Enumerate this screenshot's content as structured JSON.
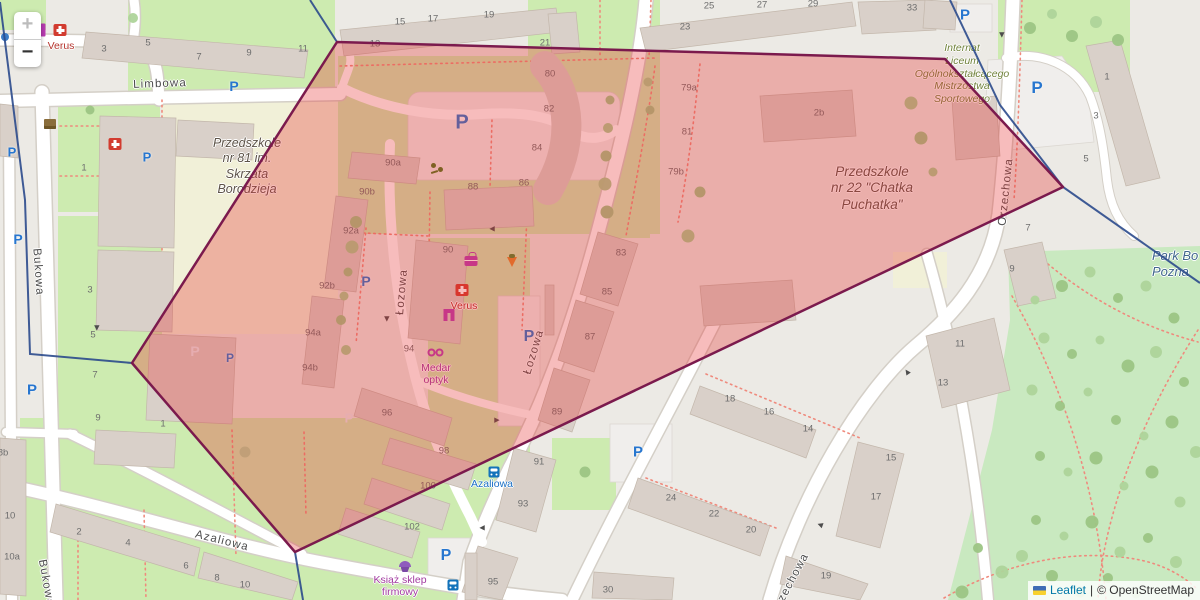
{
  "controls": {
    "zoom_in": "+",
    "zoom_out": "−"
  },
  "attribution": {
    "flag_icon": "ukraine-flag",
    "leaflet_link": "Leaflet",
    "separator": "|",
    "osm_credit": "© OpenStreetMap"
  },
  "colors": {
    "overlay_fill": "#e63030",
    "overlay_stroke": "#7b1a4d",
    "boundary_blue": "#2b4a8c",
    "parking_blue": "#2776cf",
    "bus_blue": "#1473ba",
    "pharmacy_red": "#d23b2f",
    "shop_magenta": "#b93cb1",
    "street_text": "#4c4c4c",
    "housenumber_text": "#6e6e6e",
    "kindergarten_text": "#5d5348",
    "dormitory_text": "#70823b",
    "park_text": "#40678c",
    "bus_label": "#1a6fc4",
    "pharmacy_label": "#b5342d",
    "shop_label": "#a23aa0"
  },
  "overlay": {
    "polygon_points": "337,42 945,59 1063,187 295,552 132,363",
    "fill_opacity": "0.32",
    "blue_segments": [
      "310,0 337,42",
      "0,2 25,200 30,354 132,363",
      "295,552 303,600",
      "950,0 1000,105 1063,187 1200,283"
    ]
  },
  "street_labels": [
    {
      "text": "Limbowa",
      "x": 160,
      "y": 84,
      "rot": -2
    },
    {
      "text": "Bukowa",
      "x": 38,
      "y": 272,
      "rot": 86
    },
    {
      "text": "Bukowa",
      "x": 46,
      "y": 583,
      "rot": 80
    },
    {
      "text": "Łozowa",
      "x": 402,
      "y": 292,
      "rot": -85
    },
    {
      "text": "Łozowa",
      "x": 534,
      "y": 352,
      "rot": -73
    },
    {
      "text": "Azaliowa",
      "x": 222,
      "y": 541,
      "rot": 14
    },
    {
      "text": "Orzechowa",
      "x": 1006,
      "y": 192,
      "rot": -84
    },
    {
      "text": "Orzechowa",
      "x": 790,
      "y": 584,
      "rot": -62
    }
  ],
  "area_labels": [
    {
      "name": "przedszkole-81",
      "lines": [
        "Przedszkole",
        "nr 81 im.",
        "Skrzata",
        "Borodzieja"
      ],
      "x": 247,
      "y": 136,
      "size": 12.5,
      "color_key": "kindergarten_text"
    },
    {
      "name": "przedszkole-22",
      "lines": [
        "Przedszkole",
        "nr 22 \"Chatka",
        "Puchatka\""
      ],
      "x": 872,
      "y": 164,
      "size": 13.5,
      "color_key": "kindergarten_text"
    },
    {
      "name": "internat-liceum",
      "lines": [
        "Internat",
        "Liceum",
        "Ogólnokształcącego",
        "Mistrzostwa",
        "Sportowego"
      ],
      "x": 962,
      "y": 42,
      "size": 10.5,
      "color_key": "dormitory_text"
    },
    {
      "name": "park",
      "lines": [
        "Park Bo",
        "Pozna"
      ],
      "x": 1152,
      "y": 248,
      "size": 13,
      "color_key": "park_text",
      "left_align": true
    }
  ],
  "poi_labels": [
    {
      "name": "verus-pharmacy-1",
      "lines": [
        "Verus"
      ],
      "x": 61,
      "y": 40,
      "color_key": "pharmacy_label"
    },
    {
      "name": "verus-pharmacy-2",
      "lines": [
        "Verus"
      ],
      "x": 464,
      "y": 300,
      "color_key": "pharmacy_label"
    },
    {
      "name": "medar-optyk",
      "lines": [
        "Medar",
        "optyk"
      ],
      "x": 436,
      "y": 362,
      "color_key": "shop_label"
    },
    {
      "name": "ksiaz-sklep",
      "lines": [
        "Książ sklep",
        "firmowy"
      ],
      "x": 400,
      "y": 574,
      "color_key": "shop_label"
    },
    {
      "name": "azaliowa-bus-stop",
      "lines": [
        "Azaliowa"
      ],
      "x": 492,
      "y": 478,
      "color_key": "bus_label"
    }
  ],
  "poi_icons": [
    {
      "kind": "pharmacy",
      "x": 60,
      "y": 30
    },
    {
      "kind": "pharmacy",
      "x": 115,
      "y": 144
    },
    {
      "kind": "pharmacy",
      "x": 462,
      "y": 290
    },
    {
      "kind": "parcel-locker",
      "x": 50,
      "y": 124
    },
    {
      "kind": "playground",
      "x": 437,
      "y": 168
    },
    {
      "kind": "gift-shop",
      "x": 471,
      "y": 261
    },
    {
      "kind": "greengrocer",
      "x": 512,
      "y": 262
    },
    {
      "kind": "clothes-shop",
      "x": 449,
      "y": 317
    },
    {
      "kind": "optician",
      "x": 435,
      "y": 352
    },
    {
      "kind": "confectionery",
      "x": 405,
      "y": 564
    },
    {
      "kind": "poi-dot",
      "x": 5,
      "y": 37
    },
    {
      "kind": "shop-bar",
      "x": 43,
      "y": 30
    },
    {
      "kind": "bus-stop",
      "x": 494,
      "y": 472
    },
    {
      "kind": "bus-stop",
      "x": 453,
      "y": 585
    }
  ],
  "parking": [
    [
      12,
      152,
      13,
      "b"
    ],
    [
      147,
      157,
      13,
      "b"
    ],
    [
      234,
      86,
      14,
      "b"
    ],
    [
      18,
      239,
      14,
      "b"
    ],
    [
      32,
      390,
      15,
      "b"
    ],
    [
      195,
      351,
      14,
      "l"
    ],
    [
      230,
      358,
      12,
      "b"
    ],
    [
      366,
      281,
      14,
      "b"
    ],
    [
      349,
      418,
      13,
      "l"
    ],
    [
      462,
      123,
      20,
      "b"
    ],
    [
      529,
      337,
      16,
      "b"
    ],
    [
      446,
      556,
      16,
      "b"
    ],
    [
      638,
      452,
      15,
      "b"
    ],
    [
      965,
      15,
      15,
      "b"
    ],
    [
      1037,
      88,
      17,
      "b"
    ]
  ],
  "housenumbers": [
    [
      104,
      49,
      "3"
    ],
    [
      148,
      43,
      "5"
    ],
    [
      199,
      57,
      "7"
    ],
    [
      249,
      53,
      "9"
    ],
    [
      303,
      49,
      "11"
    ],
    [
      375,
      44,
      "13"
    ],
    [
      400,
      22,
      "15"
    ],
    [
      433,
      19,
      "17"
    ],
    [
      489,
      15,
      "19"
    ],
    [
      545,
      43,
      "21"
    ],
    [
      685,
      27,
      "23"
    ],
    [
      709,
      6,
      "25"
    ],
    [
      762,
      5,
      "27"
    ],
    [
      813,
      4,
      "29"
    ],
    [
      912,
      8,
      "33"
    ],
    [
      84,
      168,
      "1"
    ],
    [
      90,
      290,
      "3"
    ],
    [
      93,
      335,
      "5"
    ],
    [
      95,
      375,
      "7"
    ],
    [
      98,
      418,
      "9"
    ],
    [
      163,
      424,
      "1"
    ],
    [
      3,
      453,
      "8b"
    ],
    [
      10,
      516,
      "10"
    ],
    [
      12,
      557,
      "10a"
    ],
    [
      79,
      532,
      "2"
    ],
    [
      128,
      543,
      "4"
    ],
    [
      186,
      566,
      "6"
    ],
    [
      217,
      578,
      "8"
    ],
    [
      245,
      585,
      "10"
    ],
    [
      550,
      74,
      "80"
    ],
    [
      549,
      109,
      "82"
    ],
    [
      537,
      148,
      "84"
    ],
    [
      524,
      183,
      "86"
    ],
    [
      473,
      187,
      "88"
    ],
    [
      448,
      250,
      "90"
    ],
    [
      393,
      163,
      "90a"
    ],
    [
      367,
      192,
      "90b"
    ],
    [
      351,
      231,
      "92a"
    ],
    [
      327,
      286,
      "92b"
    ],
    [
      313,
      333,
      "94a"
    ],
    [
      310,
      368,
      "94b"
    ],
    [
      409,
      349,
      "94"
    ],
    [
      387,
      413,
      "96"
    ],
    [
      444,
      451,
      "98"
    ],
    [
      428,
      486,
      "100"
    ],
    [
      412,
      527,
      "102"
    ],
    [
      689,
      88,
      "79a"
    ],
    [
      687,
      132,
      "81"
    ],
    [
      676,
      172,
      "79b"
    ],
    [
      819,
      113,
      "2b"
    ],
    [
      621,
      253,
      "83"
    ],
    [
      607,
      292,
      "85"
    ],
    [
      590,
      337,
      "87"
    ],
    [
      557,
      412,
      "89"
    ],
    [
      539,
      462,
      "91"
    ],
    [
      523,
      504,
      "93"
    ],
    [
      493,
      582,
      "95"
    ],
    [
      608,
      590,
      "30"
    ],
    [
      730,
      399,
      "18"
    ],
    [
      769,
      412,
      "16"
    ],
    [
      808,
      429,
      "14"
    ],
    [
      671,
      498,
      "24"
    ],
    [
      714,
      514,
      "22"
    ],
    [
      751,
      530,
      "20"
    ],
    [
      826,
      576,
      "19"
    ],
    [
      876,
      497,
      "17"
    ],
    [
      891,
      458,
      "15"
    ],
    [
      1107,
      77,
      "1"
    ],
    [
      1096,
      116,
      "3"
    ],
    [
      1086,
      159,
      "5"
    ],
    [
      1028,
      228,
      "7"
    ],
    [
      1012,
      269,
      "9"
    ],
    [
      960,
      344,
      "11"
    ],
    [
      943,
      383,
      "13"
    ]
  ],
  "trees_tinted": [
    [
      356,
      222
    ],
    [
      352,
      247
    ],
    [
      348,
      272
    ],
    [
      344,
      296
    ],
    [
      341,
      320
    ],
    [
      346,
      350
    ],
    [
      610,
      100
    ],
    [
      608,
      128
    ],
    [
      606,
      156
    ],
    [
      605,
      184
    ],
    [
      607,
      212
    ],
    [
      648,
      82
    ],
    [
      650,
      110
    ],
    [
      688,
      236
    ],
    [
      700,
      192
    ],
    [
      911,
      103
    ],
    [
      921,
      138
    ],
    [
      933,
      172
    ]
  ],
  "trees_park": [
    [
      1030,
      28
    ],
    [
      1052,
      14
    ],
    [
      1072,
      36
    ],
    [
      1096,
      22
    ],
    [
      1118,
      40
    ],
    [
      1035,
      300
    ],
    [
      1062,
      286
    ],
    [
      1090,
      272
    ],
    [
      1118,
      298
    ],
    [
      1146,
      286
    ],
    [
      1174,
      318
    ],
    [
      1044,
      338
    ],
    [
      1072,
      354
    ],
    [
      1100,
      340
    ],
    [
      1128,
      366
    ],
    [
      1156,
      352
    ],
    [
      1184,
      382
    ],
    [
      1032,
      390
    ],
    [
      1060,
      406
    ],
    [
      1088,
      392
    ],
    [
      1116,
      420
    ],
    [
      1144,
      436
    ],
    [
      1172,
      422
    ],
    [
      1196,
      452
    ],
    [
      1040,
      456
    ],
    [
      1068,
      472
    ],
    [
      1096,
      458
    ],
    [
      1124,
      486
    ],
    [
      1152,
      472
    ],
    [
      1180,
      502
    ],
    [
      1036,
      520
    ],
    [
      1064,
      536
    ],
    [
      1092,
      522
    ],
    [
      1120,
      552
    ],
    [
      1148,
      538
    ],
    [
      1176,
      562
    ],
    [
      1052,
      576
    ],
    [
      1080,
      592
    ],
    [
      1108,
      578
    ],
    [
      1136,
      594
    ],
    [
      978,
      548
    ],
    [
      1002,
      572
    ],
    [
      962,
      592
    ],
    [
      1022,
      556
    ],
    [
      585,
      472
    ],
    [
      133,
      18
    ],
    [
      90,
      110
    ],
    [
      245,
      452
    ]
  ],
  "arrows": [
    [
      97,
      328,
      90
    ],
    [
      492,
      229,
      180
    ],
    [
      387,
      319,
      90
    ],
    [
      497,
      420,
      0
    ],
    [
      482,
      528,
      180
    ],
    [
      1002,
      35,
      90
    ],
    [
      907,
      372,
      235
    ],
    [
      820,
      525,
      200
    ]
  ]
}
